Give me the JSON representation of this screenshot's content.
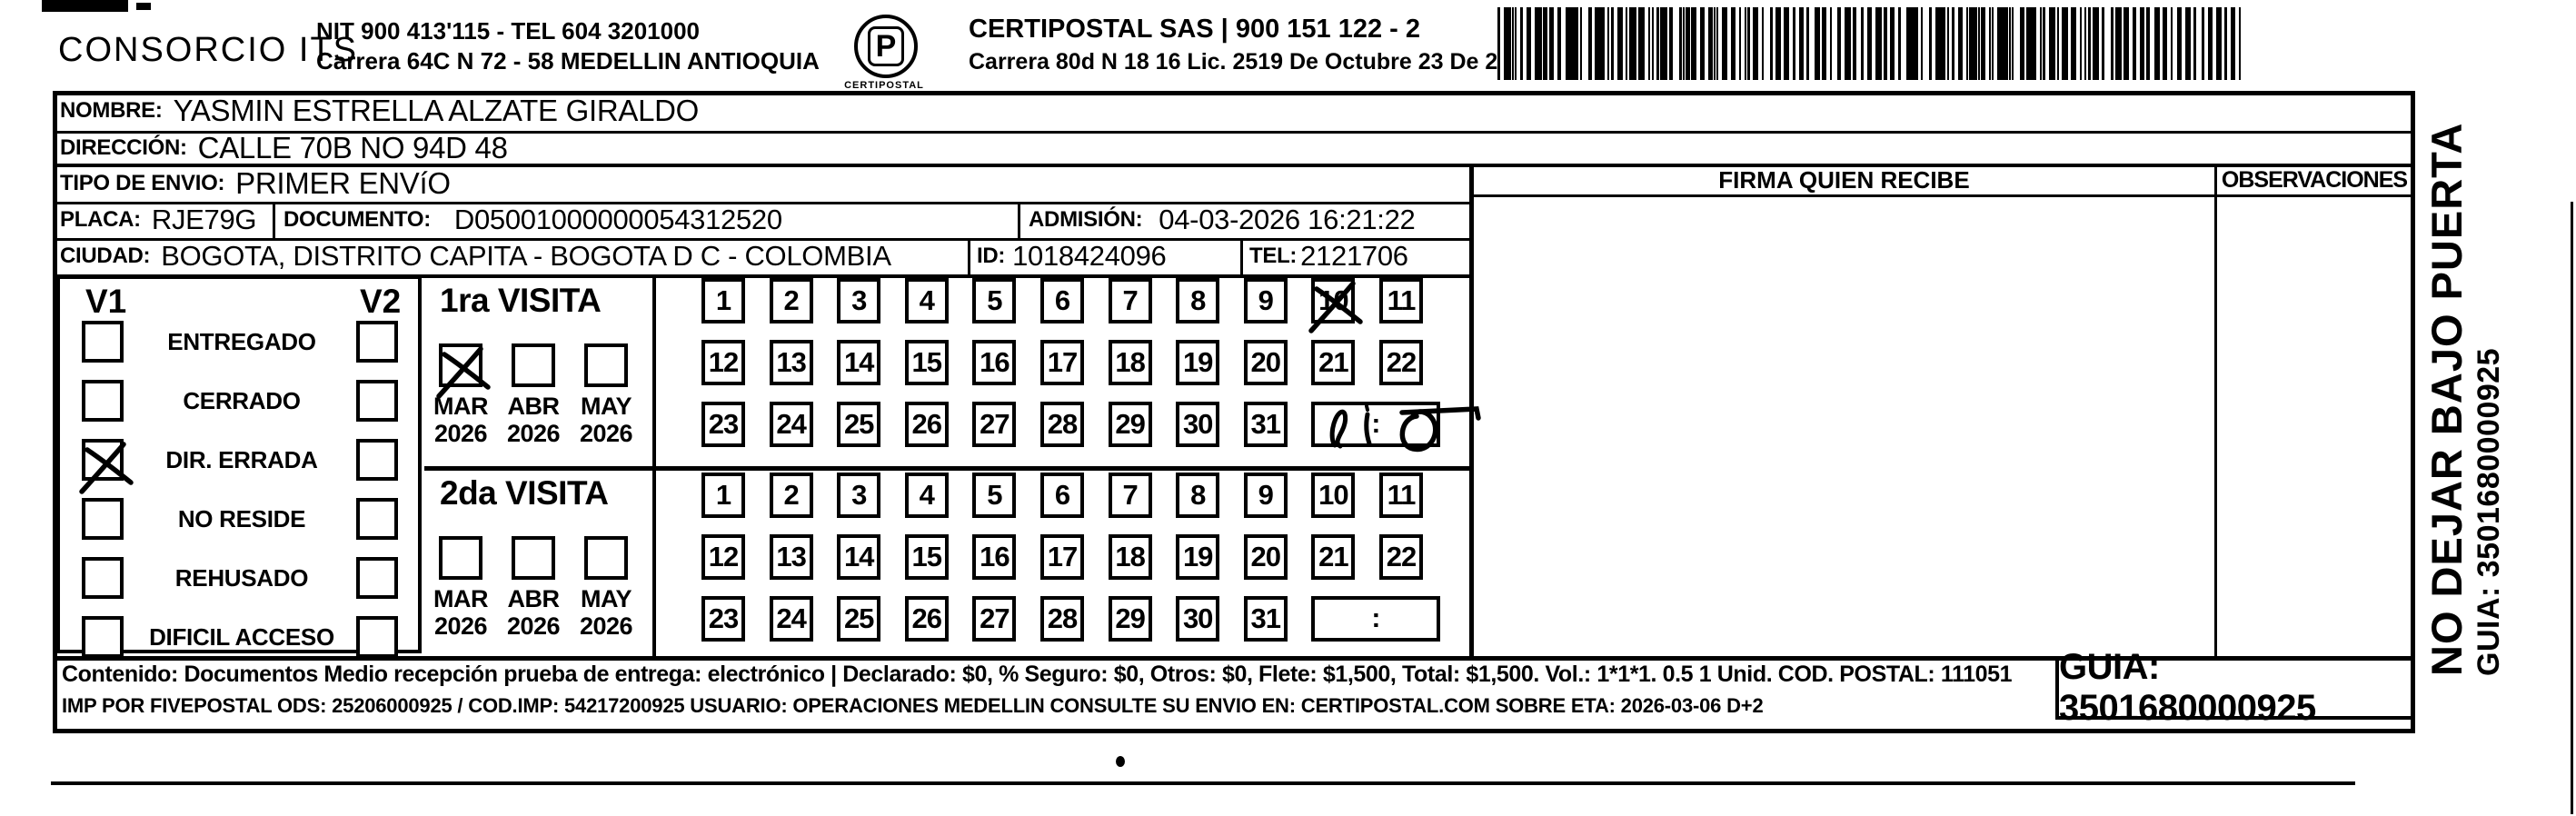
{
  "header": {
    "company": "CONSORCIO ITS",
    "nit_line1": "NIT 900 413'115 - TEL 604 3201000",
    "nit_line2": "Carrera 64C N 72 - 58 MEDELLIN ANTIOQUIA",
    "logo_glyph": "P",
    "logo_caption": "CERTIPOSTAL",
    "sas_line1": "CERTIPOSTAL SAS | 900 151 122 - 2",
    "sas_line2": "Carrera 80d N 18 16  Lic. 2519 De Octubre 23 De 2015"
  },
  "recipient": {
    "nombre_label": "NOMBRE:",
    "nombre_value": "YASMIN ESTRELLA ALZATE GIRALDO",
    "direccion_label": "DIRECCIÓN:",
    "direccion_value": "CALLE 70B NO 94D 48",
    "tipo_label": "TIPO DE ENVIO:",
    "tipo_value": "PRIMER ENVíO",
    "placa_label": "PLACA:",
    "placa_value": "RJE79G",
    "documento_label": "DOCUMENTO:",
    "documento_value": "D05001000000054312520",
    "admision_label": "ADMISIÓN:",
    "admision_value": "04-03-2026 16:21:22",
    "ciudad_label": "CIUDAD:",
    "ciudad_value": "BOGOTA, DISTRITO CAPITA - BOGOTA D C - COLOMBIA",
    "id_label": "ID:",
    "id_value": "1018424096",
    "tel_label": "TEL:",
    "tel_value": "2121706"
  },
  "status_panel": {
    "col1_header": "V1",
    "col2_header": "V2",
    "options": [
      {
        "label": "ENTREGADO",
        "v1_checked": false,
        "v2_checked": false
      },
      {
        "label": "CERRADO",
        "v1_checked": false,
        "v2_checked": false
      },
      {
        "label": "DIR. ERRADA",
        "v1_checked": true,
        "v2_checked": false
      },
      {
        "label": "NO RESIDE",
        "v1_checked": false,
        "v2_checked": false
      },
      {
        "label": "REHUSADO",
        "v1_checked": false,
        "v2_checked": false
      },
      {
        "label": "DIFICIL ACCESO",
        "v1_checked": false,
        "v2_checked": false
      }
    ]
  },
  "visits": [
    {
      "title": "1ra VISITA",
      "months": [
        {
          "label": "MAR",
          "year": "2026",
          "checked": true
        },
        {
          "label": "ABR",
          "year": "2026",
          "checked": false
        },
        {
          "label": "MAY",
          "year": "2026",
          "checked": false
        }
      ],
      "days": [
        1,
        2,
        3,
        4,
        5,
        6,
        7,
        8,
        9,
        10,
        11,
        12,
        13,
        14,
        15,
        16,
        17,
        18,
        19,
        20,
        21,
        22,
        23,
        24,
        25,
        26,
        27,
        28,
        29,
        30,
        31
      ],
      "crossed_day": 10,
      "time_separator": ":",
      "handwritten_time": true
    },
    {
      "title": "2da VISITA",
      "months": [
        {
          "label": "MAR",
          "year": "2026",
          "checked": false
        },
        {
          "label": "ABR",
          "year": "2026",
          "checked": false
        },
        {
          "label": "MAY",
          "year": "2026",
          "checked": false
        }
      ],
      "days": [
        1,
        2,
        3,
        4,
        5,
        6,
        7,
        8,
        9,
        10,
        11,
        12,
        13,
        14,
        15,
        16,
        17,
        18,
        19,
        20,
        21,
        22,
        23,
        24,
        25,
        26,
        27,
        28,
        29,
        30,
        31
      ],
      "crossed_day": null,
      "time_separator": ":",
      "handwritten_time": false
    }
  ],
  "signature_panel": {
    "firma_header": "FIRMA QUIEN RECIBE",
    "observaciones_header": "OBSERVACIONES"
  },
  "side_note": {
    "line1": "NO DEJAR BAJO PUERTA",
    "line2": "GUIA: 3501680000925"
  },
  "footer": {
    "line1": "Contenido: Documentos Medio recepción prueba de entrega: electrónico | Declarado: $0, % Seguro: $0, Otros: $0, Flete: $1,500, Total: $1,500. Vol.: 1*1*1. 0.5  1 Unid. COD. POSTAL: 111051",
    "line2": "IMP POR FIVEPOSTAL ODS: 25206000925 / COD.IMP: 54217200925 USUARIO: OPERACIONES MEDELLIN CONSULTE SU ENVIO EN: CERTIPOSTAL.COM SOBRE ETA: 2026-03-06 D+2",
    "guia_box": "GUIA: 3501680000925"
  }
}
